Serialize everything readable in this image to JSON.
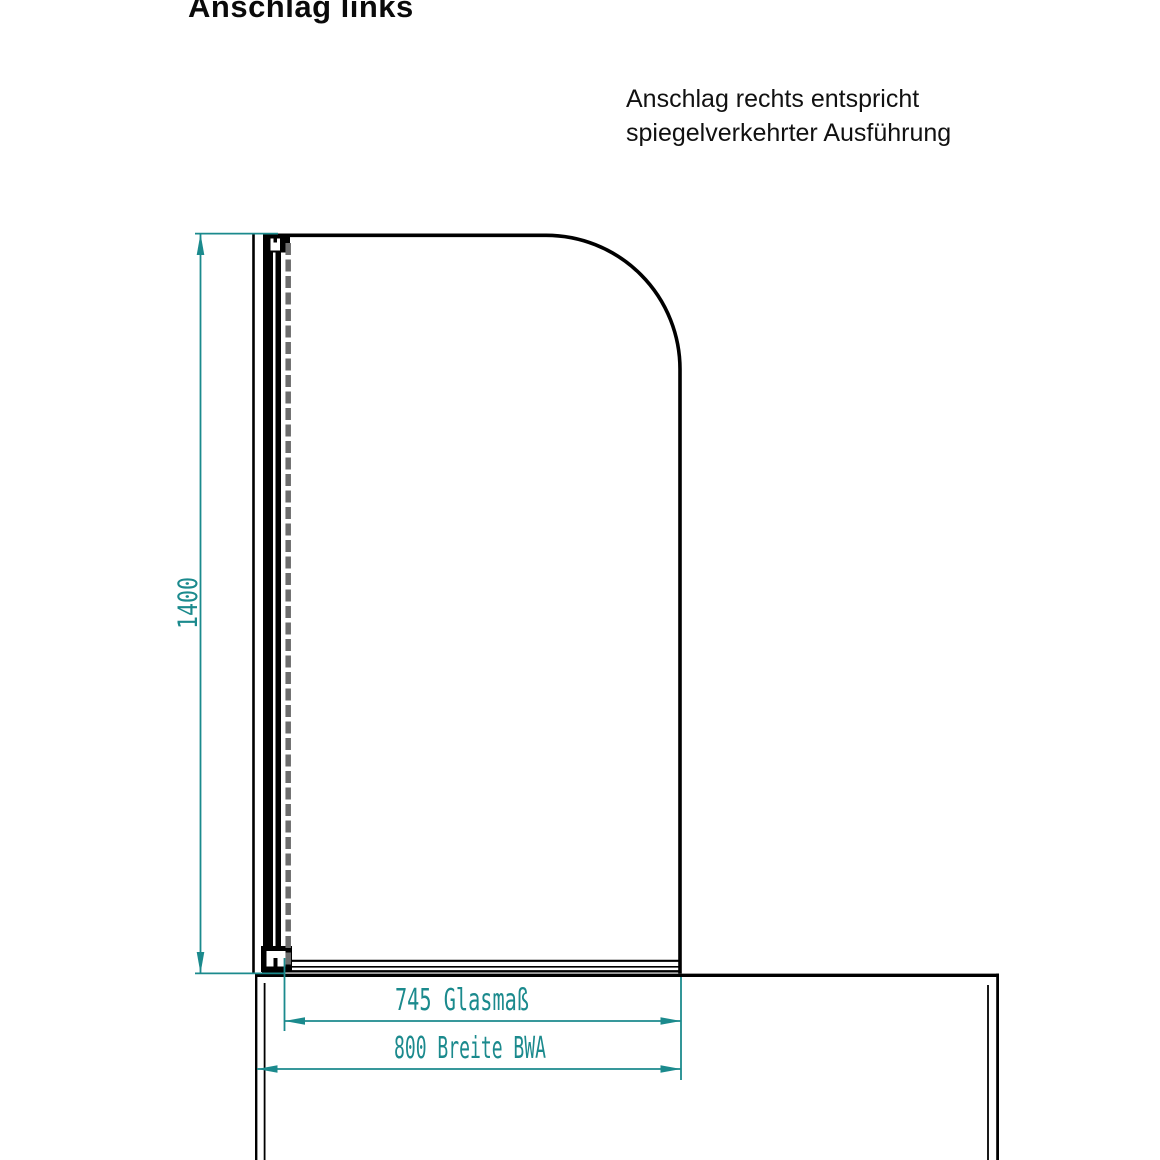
{
  "title": "Anschlag links",
  "note": {
    "line1": "Anschlag rechts entspricht",
    "line2": "spiegelverkehrter Ausführung"
  },
  "dimensions": {
    "height_label": "1400",
    "glass_width_label": "745 Glasmaß",
    "overall_width_label": "800 Breite BWA"
  },
  "colors": {
    "dimension": "#1b8a8d",
    "outline": "#000000",
    "hidden": "#6d6d6d"
  }
}
